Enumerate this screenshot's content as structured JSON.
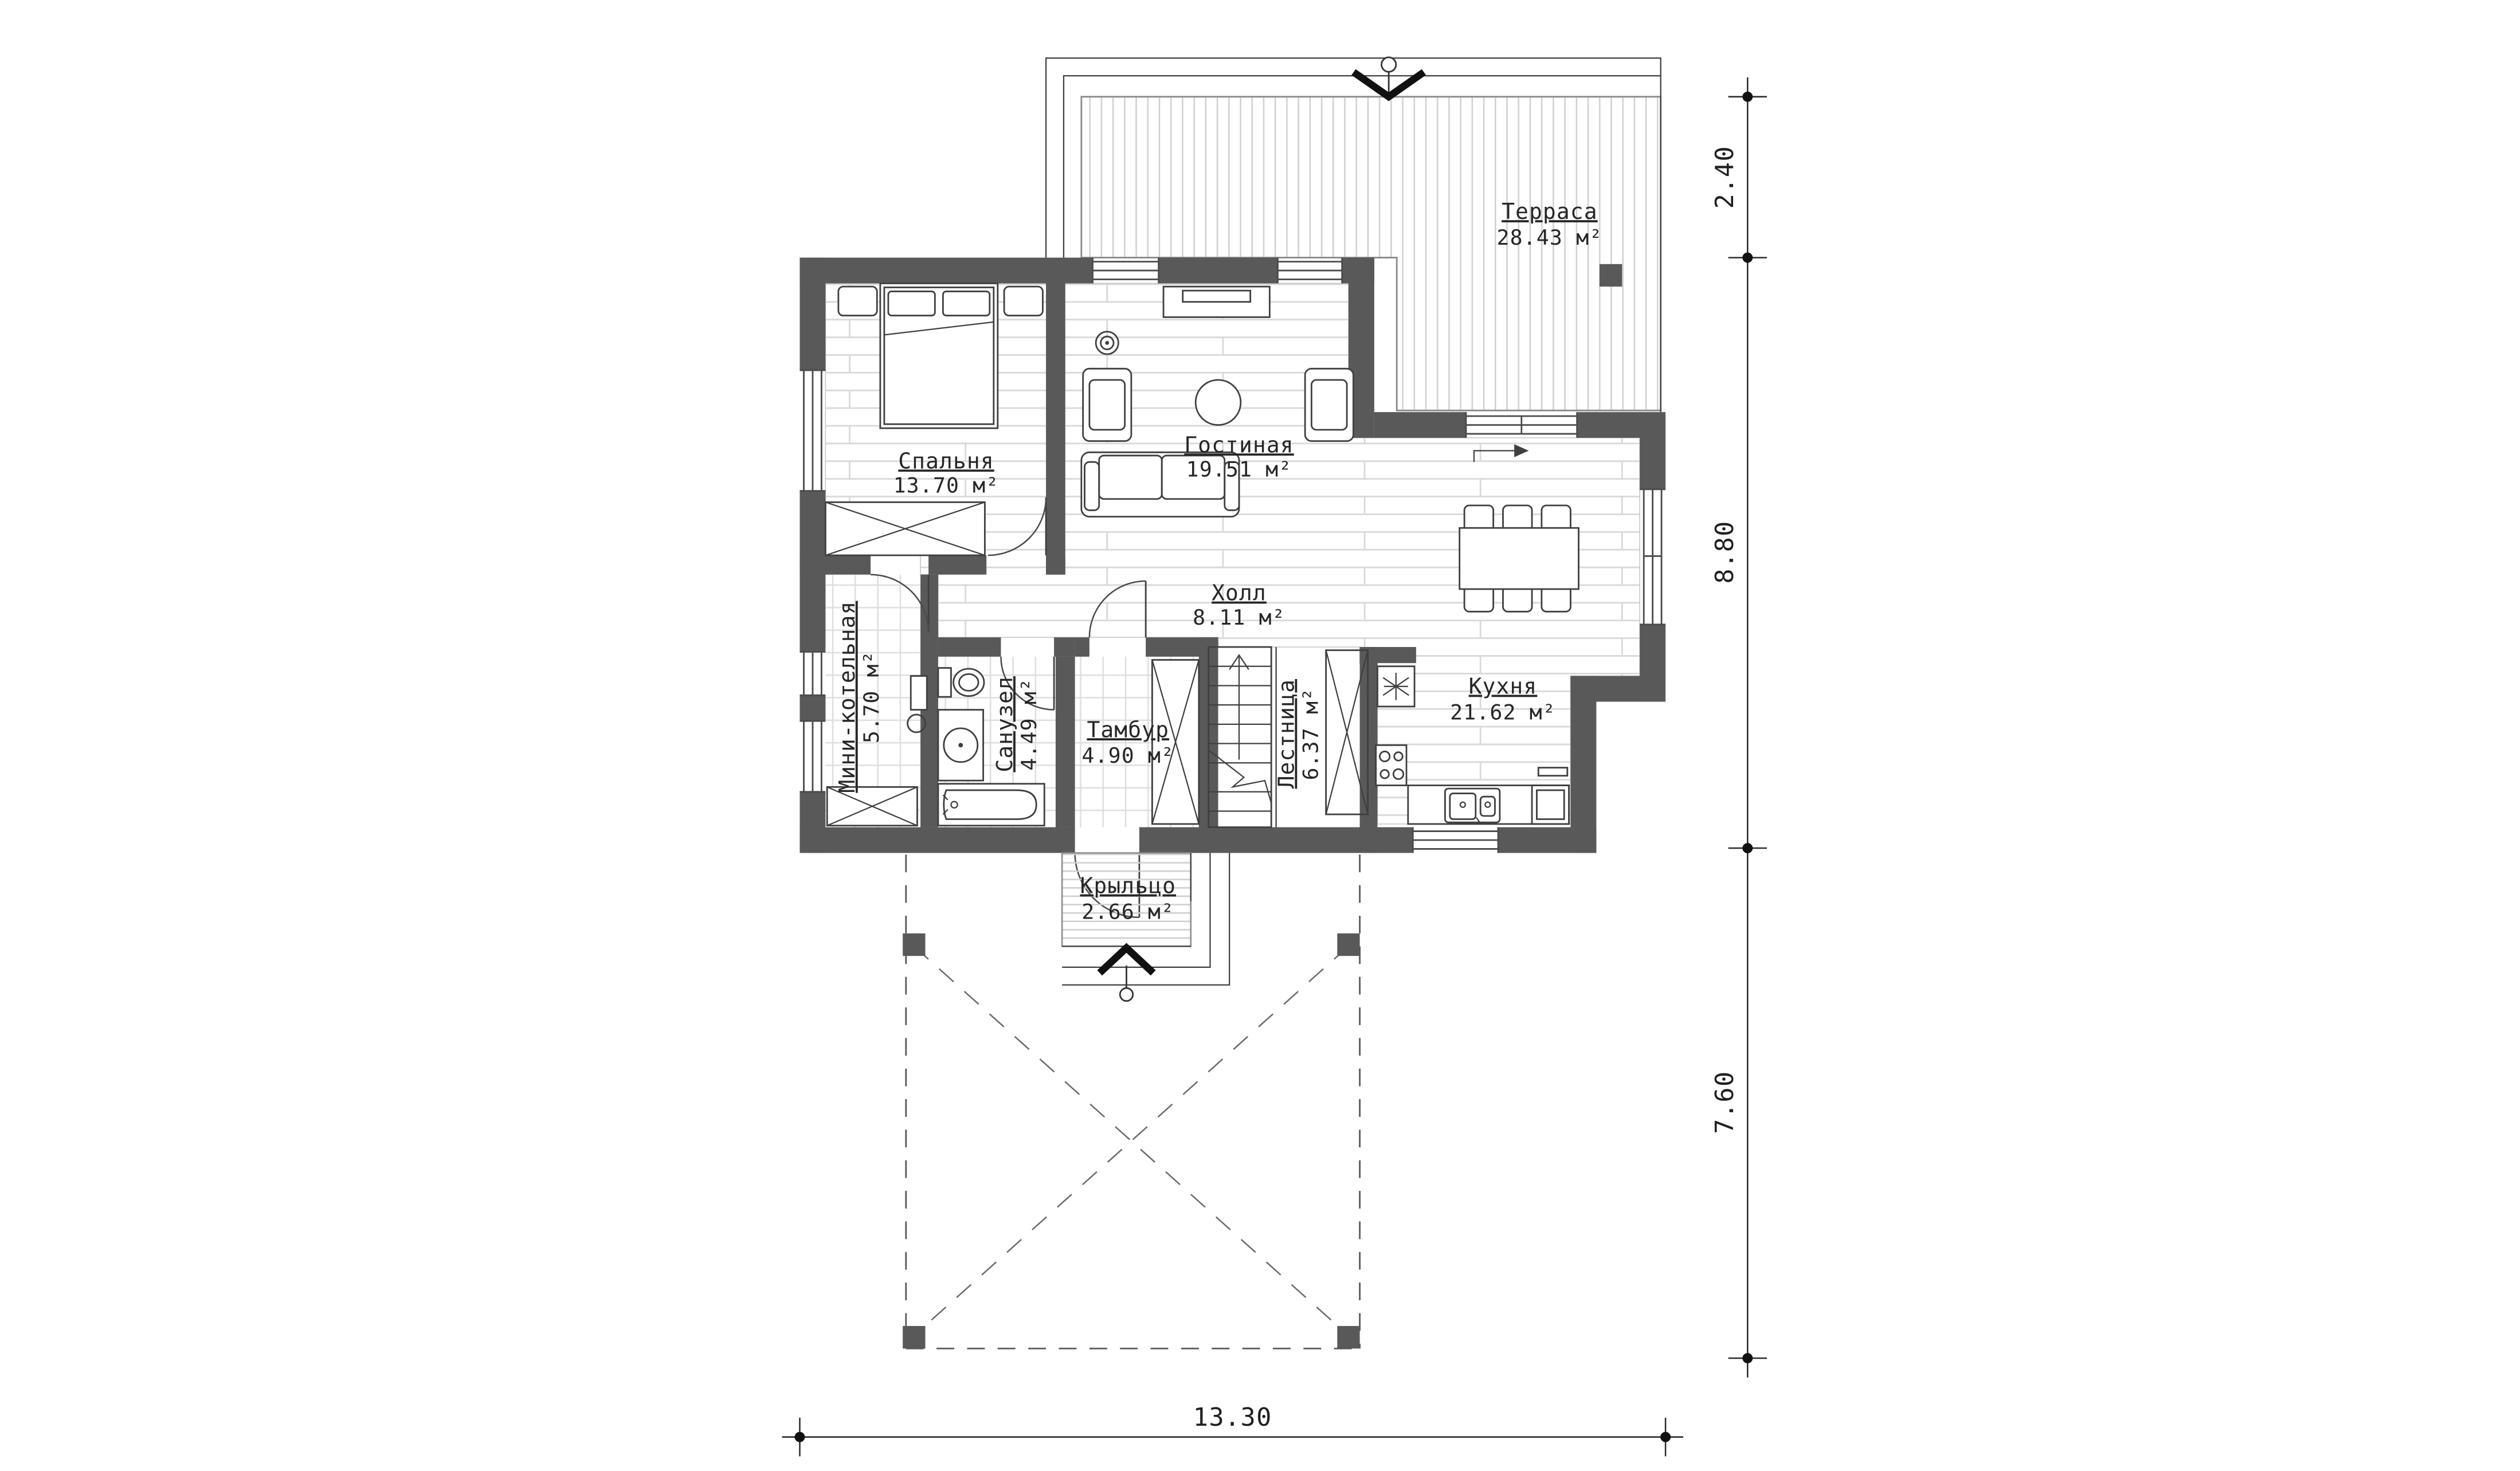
{
  "rooms": {
    "terrace": {
      "name": "Терраса",
      "area": "28.43 м²"
    },
    "bedroom": {
      "name": "Спальня",
      "area": "13.70 м²"
    },
    "living": {
      "name": "Гостиная",
      "area": "19.51 м²"
    },
    "hall": {
      "name": "Холл",
      "area": "8.11 м²"
    },
    "boiler": {
      "name": "Мини-котельная",
      "area": "5.70 м²"
    },
    "bathroom": {
      "name": "Санузел",
      "area": "4.49 м²"
    },
    "tambour": {
      "name": "Тамбур",
      "area": "4.90 м²"
    },
    "stairs": {
      "name": "Лестница",
      "area": "6.37 м²"
    },
    "kitchen": {
      "name": "Кухня",
      "area": "21.62 м²"
    },
    "porch": {
      "name": "Крыльцо",
      "area": "2.66 м²"
    }
  },
  "dimensions": {
    "terrace_depth": "2.40",
    "house_depth": "8.80",
    "carport_depth": "7.60",
    "total_width": "13.30"
  },
  "colors": {
    "wall": "#595959",
    "line": "#3f3f3f",
    "floor-line": "#d9d9d9"
  }
}
